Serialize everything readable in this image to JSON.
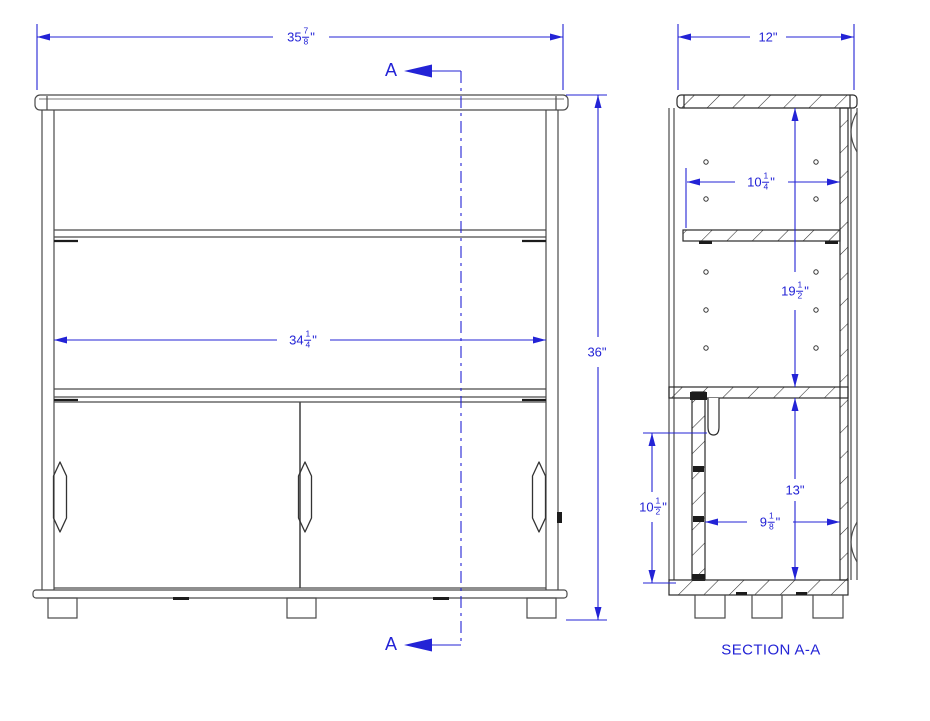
{
  "colors": {
    "dimension_blue": "#2323d6",
    "line_gray": "#4a4a4a",
    "cut_black": "#1c1c1c",
    "background": "#ffffff"
  },
  "front_view": {
    "name": "front-elevation",
    "section_marker": "A",
    "dims": {
      "overall_width": {
        "whole": "35",
        "num": "7",
        "den": "8",
        "unit": "\""
      },
      "interior_width": {
        "whole": "34",
        "num": "1",
        "den": "4",
        "unit": "\""
      },
      "overall_height": {
        "whole": "36",
        "unit": "\""
      }
    }
  },
  "section_view": {
    "title": "SECTION A-A",
    "dims": {
      "depth": {
        "whole": "12",
        "unit": "\""
      },
      "shelf_clear_depth": {
        "whole": "10",
        "num": "1",
        "den": "4",
        "unit": "\""
      },
      "upper_opening_height": {
        "whole": "19",
        "num": "1",
        "den": "2",
        "unit": "\""
      },
      "lower_opening_height": {
        "whole": "13",
        "unit": "\""
      },
      "door_height": {
        "whole": "10",
        "num": "1",
        "den": "2",
        "unit": "\""
      },
      "lower_clear_depth": {
        "whole": "9",
        "num": "1",
        "den": "8",
        "unit": "\""
      }
    }
  }
}
